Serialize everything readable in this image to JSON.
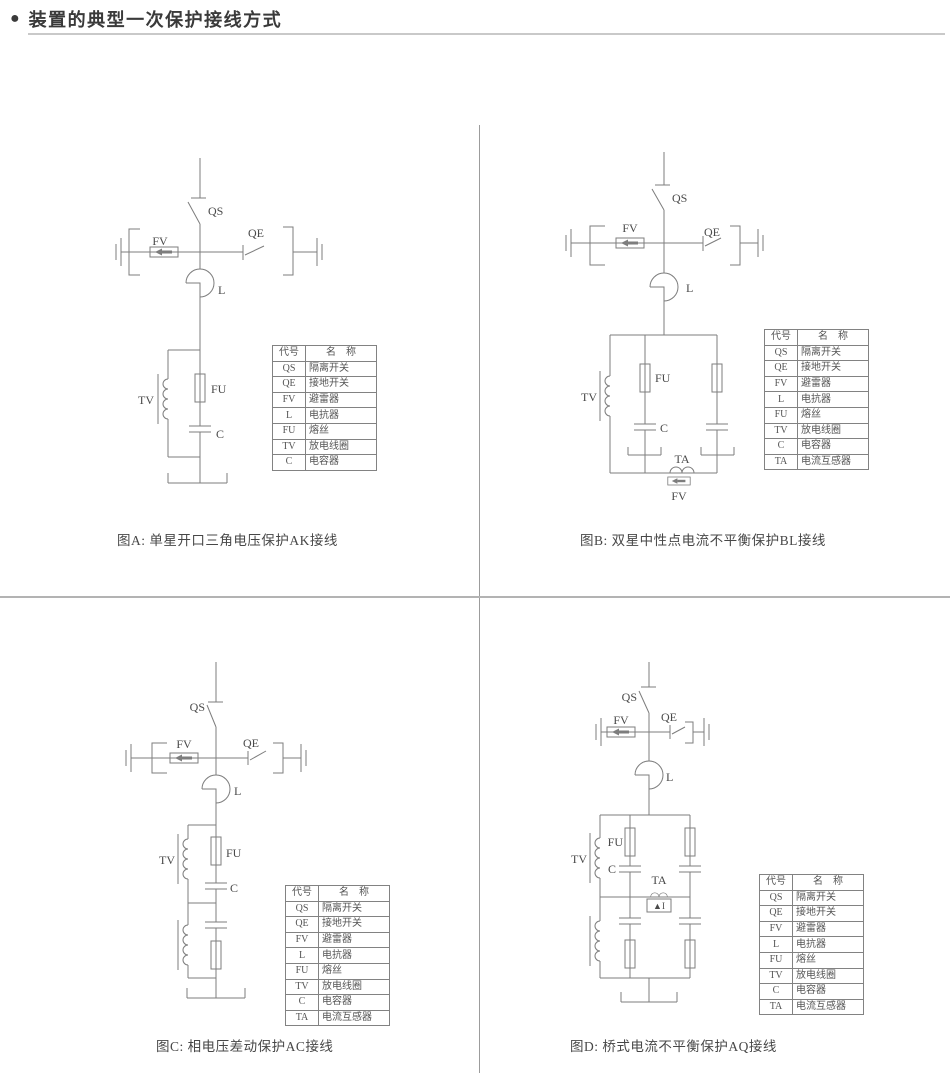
{
  "page": {
    "bullet": "●",
    "title": "装置的典型一次保护接线方式"
  },
  "legend": {
    "header": {
      "code": "代号",
      "name": "名　称"
    },
    "items": [
      {
        "code": "QS",
        "name": "隔离开关"
      },
      {
        "code": "QE",
        "name": "接地开关"
      },
      {
        "code": "FV",
        "name": "避雷器"
      },
      {
        "code": "L",
        "name": "电抗器"
      },
      {
        "code": "FU",
        "name": "熔丝"
      },
      {
        "code": "TV",
        "name": "放电线圈"
      },
      {
        "code": "C",
        "name": "电容器"
      },
      {
        "code": "TA",
        "name": "电流互感器"
      }
    ]
  },
  "component_labels": {
    "qs": "QS",
    "qe": "QE",
    "fv": "FV",
    "l": "L",
    "fu": "FU",
    "tv": "TV",
    "c": "C",
    "ta": "TA",
    "delta_i": "▲I"
  },
  "diagrams": {
    "a": {
      "caption": "图A: 单星开口三角电压保护AK接线"
    },
    "b": {
      "caption": "图B: 双星中性点电流不平衡保护BL接线"
    },
    "c": {
      "caption": "图C: 相电压差动保护AC接线"
    },
    "d": {
      "caption": "图D: 桥式电流不平衡保护AQ接线"
    }
  }
}
